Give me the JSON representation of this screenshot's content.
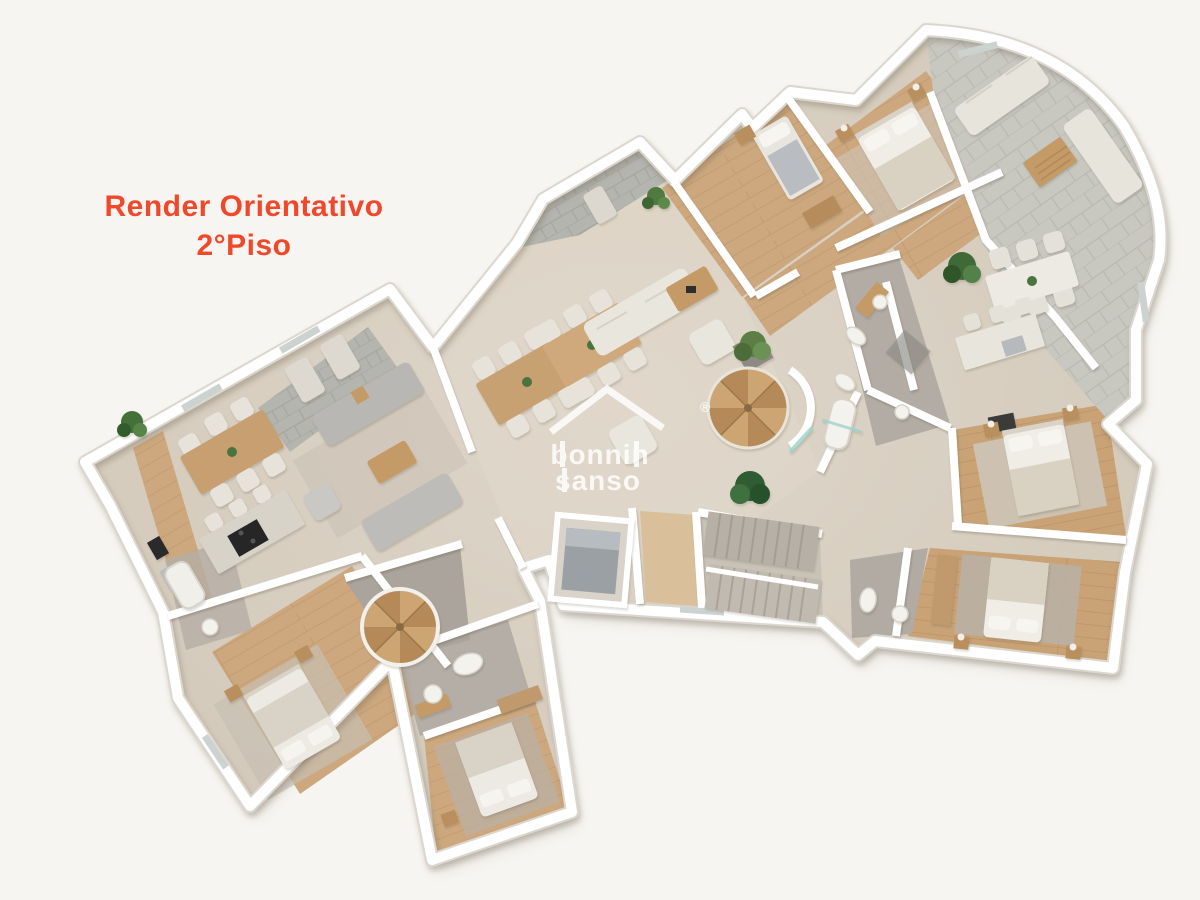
{
  "page": {
    "background": "#f7f5f1",
    "description": "3D rendered top-down architectural floor plan of a second floor"
  },
  "title": {
    "line1": "Render Orientativo",
    "line2": "2°Piso",
    "color": "#f0482b"
  },
  "watermark": {
    "line1": "bonnin",
    "line2": "sanso",
    "registered": "®",
    "color": "#ffffff"
  },
  "palette": {
    "accent_orange": "#f0482b",
    "background": "#f7f5f1",
    "wall_white": "#ffffff",
    "concrete_floor": "#d6ccbe",
    "wood_floor": "#cda87e",
    "stone_terrace": "#b6b7b0",
    "stone_terrace_light": "#c9c9c2",
    "bath_floor_gray": "#b3aca4",
    "sofa_white": "#e9e6de",
    "sofa_gray": "#b8b7b3",
    "furniture_wood": "#c49a66",
    "plant_green": "#4a6f3c",
    "glass_teal": "#9fd4cb"
  }
}
